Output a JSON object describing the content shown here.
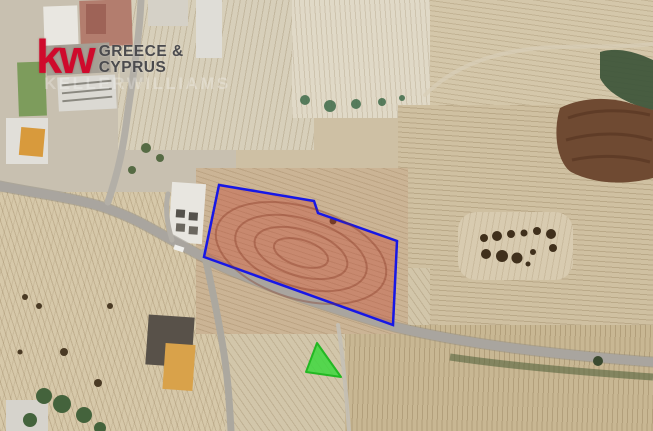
{
  "branding": {
    "logo_text": "kw",
    "region_line1": "GREECE &",
    "region_line2": "CYPRUS",
    "watermark_text": "KELLERWILLIAMS",
    "logo_color": "#cf0a2c",
    "region_text_color": "#4b4b4e"
  },
  "map": {
    "type": "satellite-aerial-photo",
    "plot": {
      "points": "219,185 314,201 318,213 397,241 393,325 204,257",
      "fill": "rgba(193,62,43,0.36)",
      "stroke": "#1717e6",
      "stroke_width": "2.5"
    },
    "marker": {
      "points": "317,343 306,372 341,377",
      "fill": "rgba(62,216,62,0.85)",
      "stroke": "#23b823",
      "stroke_width": "2"
    }
  }
}
